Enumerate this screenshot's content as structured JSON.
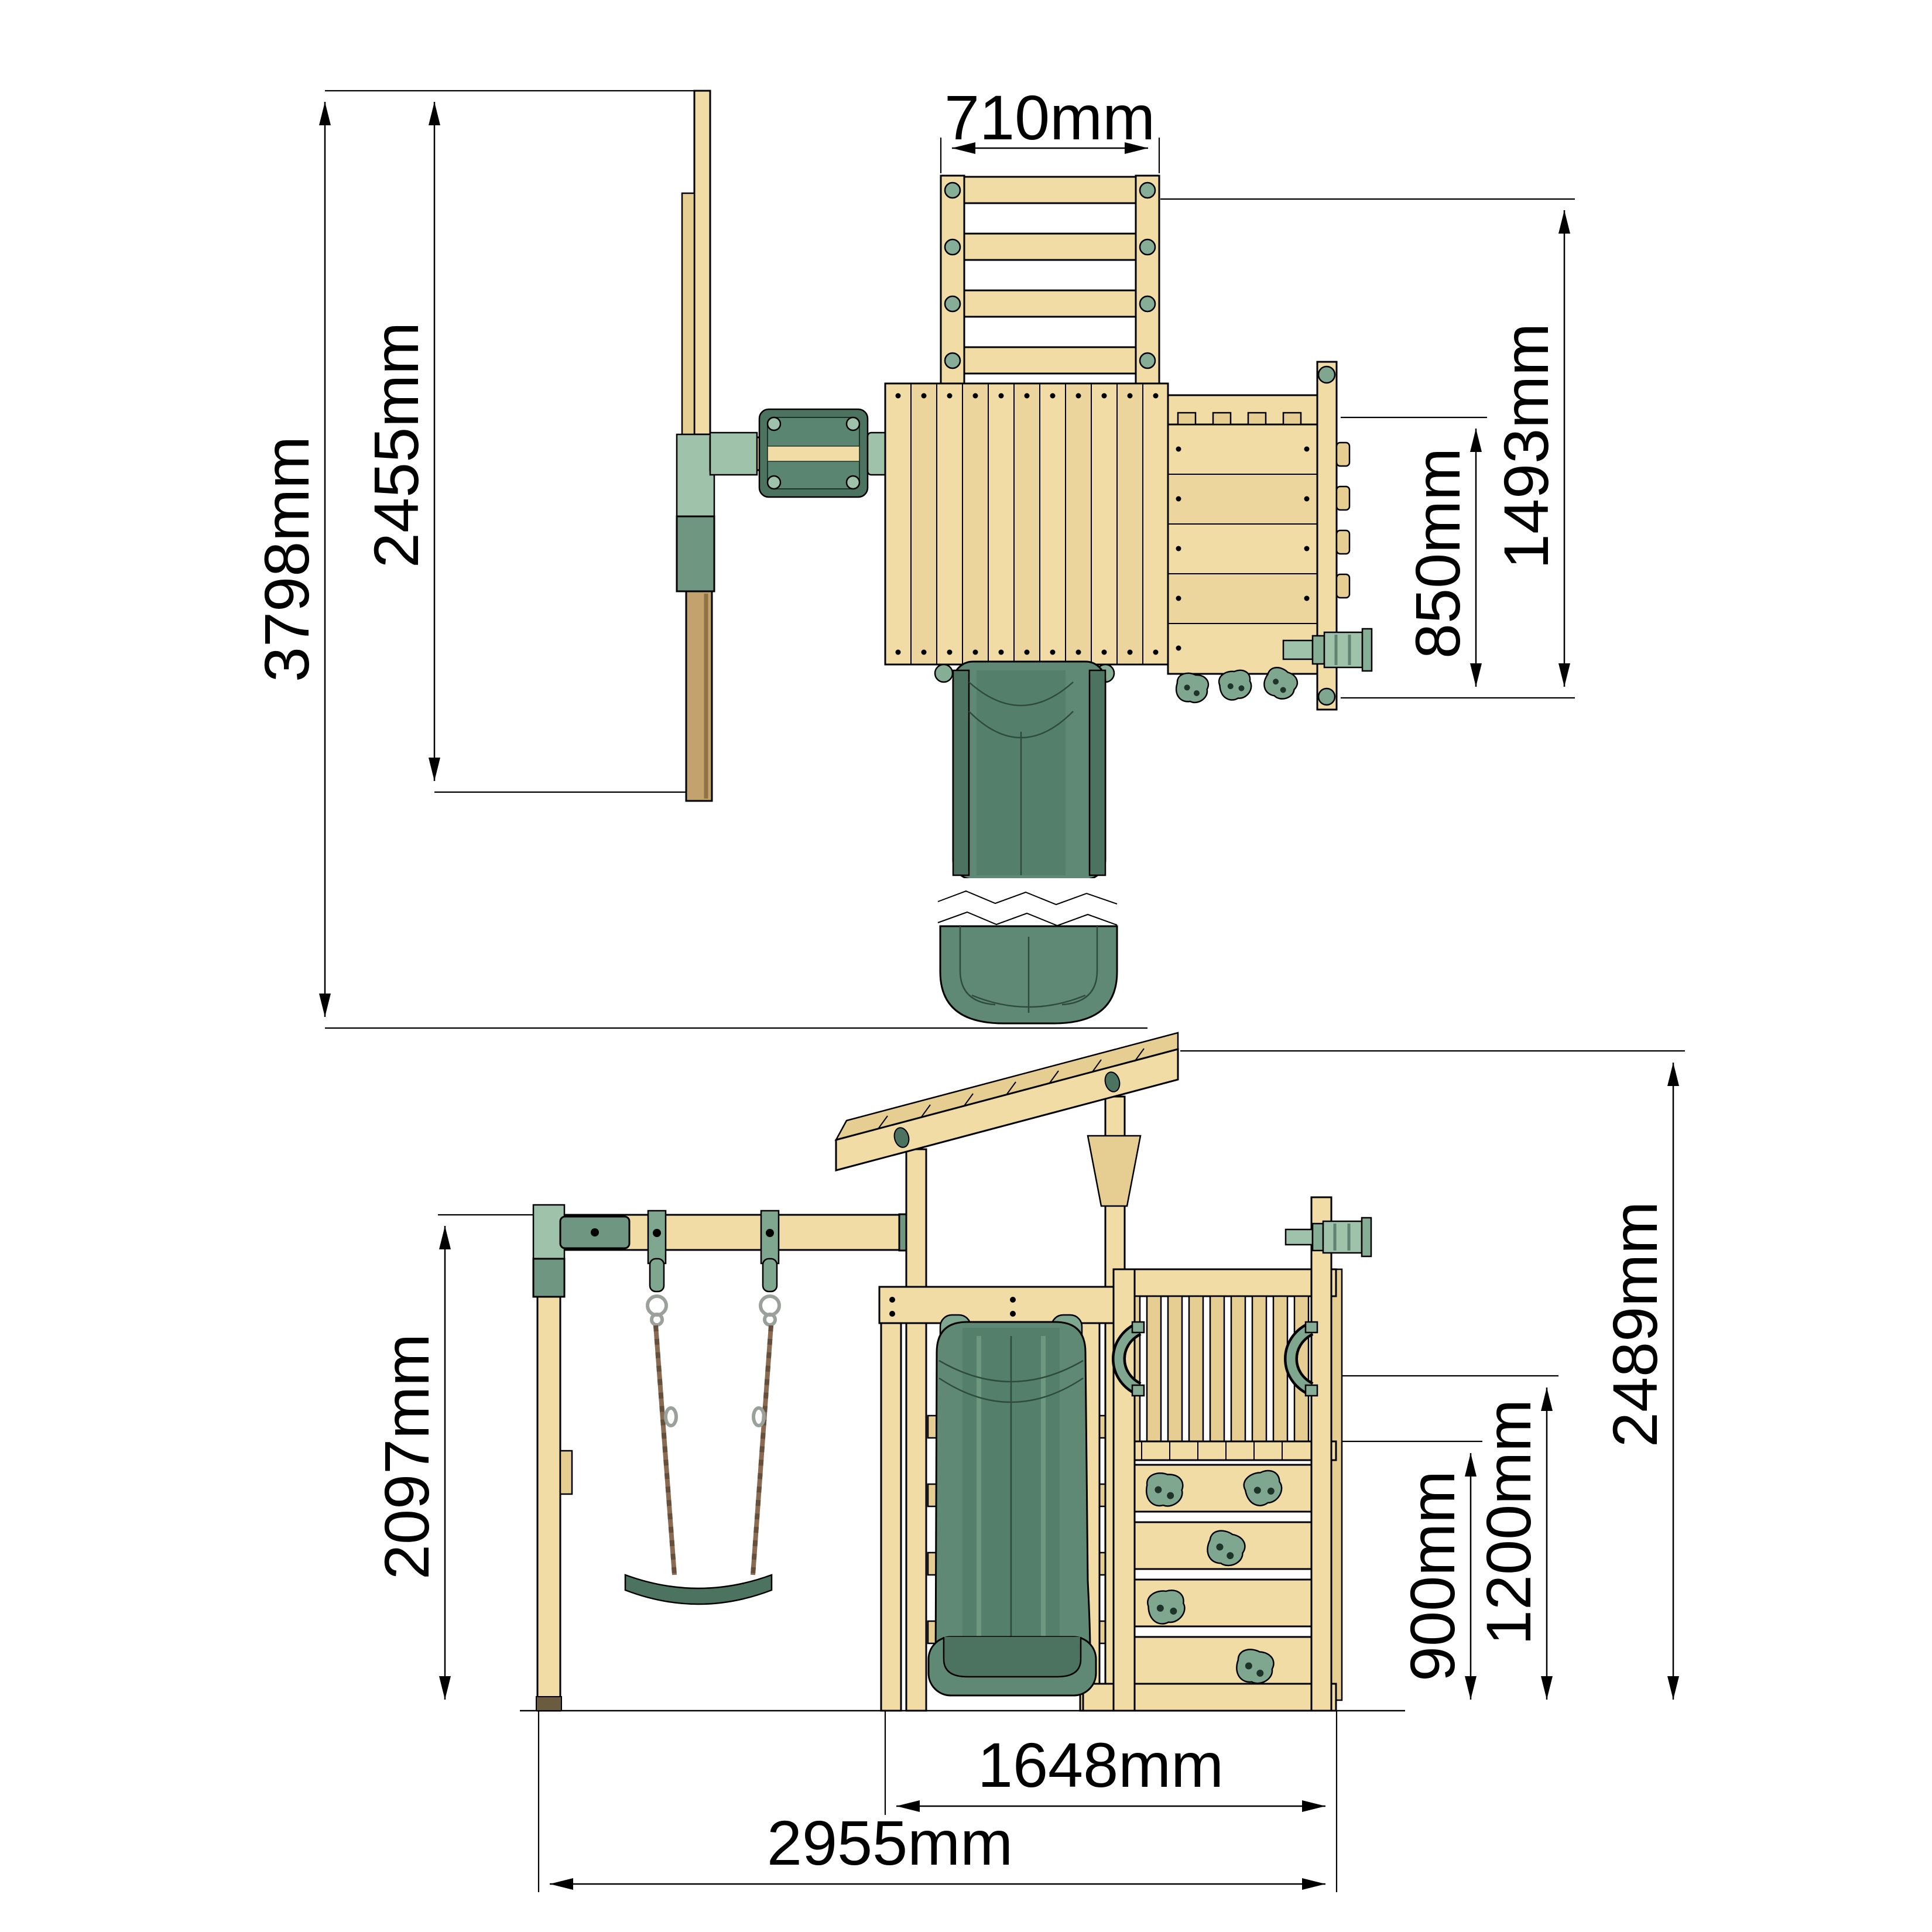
{
  "document": {
    "type": "technical-dimension-drawing",
    "subject": "wooden playground set with swing, tower, slide and climbing wall",
    "background_color": "#ffffff",
    "line_color": "#000000",
    "colors": {
      "wood_light": "#F0DCA4",
      "wood_mid": "#E6CD92",
      "wood_dark_post": "#C3A26E",
      "slide_green": "#5F8974",
      "green_dark": "#4C7260",
      "green_mid": "#7FA78F",
      "green_light": "#9FC2AA",
      "rope_brown": "#8A6B52"
    }
  },
  "top": {
    "name": "top view (plan)",
    "dims": {
      "ladder_width": "710mm",
      "swing_depth": "2455mm",
      "overall_depth": "3798mm",
      "platform_depth": "850mm",
      "platform_overall_depth": "1493mm"
    }
  },
  "side": {
    "name": "side view (elevation)",
    "dims": {
      "swing_height": "2097mm",
      "wall_height": "900mm",
      "platform_height": "1200mm",
      "overall_height": "2489mm",
      "tower_length": "1648mm",
      "overall_length": "2955mm"
    }
  }
}
